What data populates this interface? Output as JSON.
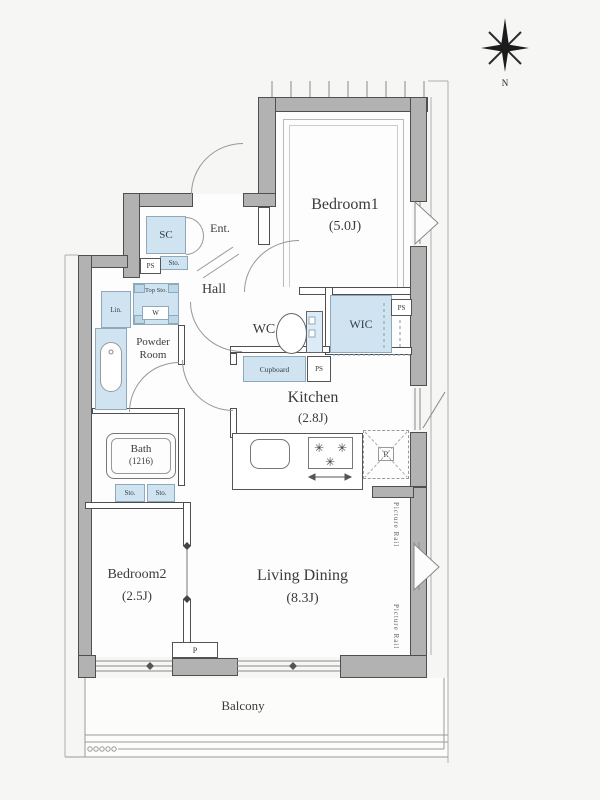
{
  "floorplan": {
    "compass_label": "N",
    "rooms": {
      "bedroom1": {
        "name": "Bedroom1",
        "size": "(5.0J)"
      },
      "bedroom2": {
        "name": "Bedroom2",
        "size": "(2.5J)"
      },
      "living_dining": {
        "name": "Living Dining",
        "size": "(8.3J)"
      },
      "kitchen": {
        "name": "Kitchen",
        "size": "(2.8J)"
      },
      "bath": {
        "name": "Bath",
        "size": "(1216)"
      },
      "powder_room": {
        "name": "Powder Room"
      },
      "wc": {
        "name": "WC"
      },
      "wic": {
        "name": "WIC"
      },
      "hall": {
        "name": "Hall"
      },
      "entrance": {
        "name": "Ent."
      },
      "balcony": {
        "name": "Balcony"
      }
    },
    "labels": {
      "shoe_closet": "SC",
      "pipe_space": "PS",
      "storage": "Sto.",
      "top_storage": "Top Sto.",
      "washer": "W",
      "linen": "Lin.",
      "cupboard": "Cupboard",
      "refrigerator": "R",
      "pillar": "P",
      "picture_rail": "Picture Rail"
    },
    "colors": {
      "wall_fill": "#b2b2b2",
      "wall_edge": "#4f4f4f",
      "storage_fill": "#cfe4f0",
      "storage_edge": "#8fa9bb",
      "background": "#f6f6f4"
    }
  }
}
